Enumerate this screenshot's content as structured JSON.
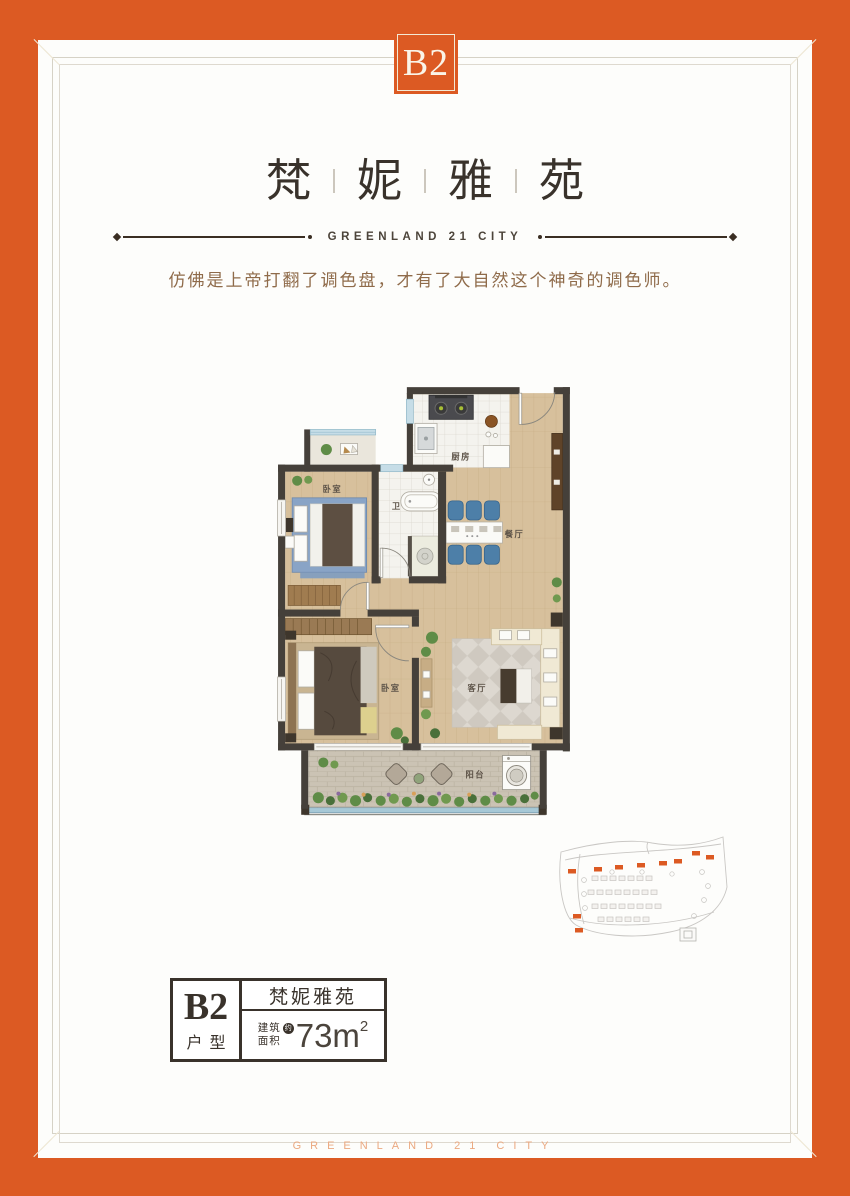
{
  "theme": {
    "accent": "#dc5a23",
    "ink": "#39322b",
    "divider": "#3a2e23",
    "brandtext": "#4c443a",
    "tagline": "#8f6b4a",
    "frameline1": "#d6d2c6",
    "frameline2": "#ded9cf",
    "tick": "#efe8d5",
    "watermark": "#eba981",
    "wall": "#45403a",
    "wood": "#d7c09c",
    "woodline": "#c3a981",
    "tile": "#f4f3ee",
    "tileline": "#dbd8cf",
    "stone": "#cbc3b4",
    "stoneline": "#b7af9e",
    "plant": "#5f8c47",
    "bluefurn": "#4d7fa8",
    "windowc": "#c6dde7",
    "railing": "#a6c8d6",
    "cream": "#f0e9d4",
    "roomlabel": "#5d5348",
    "infoink": "#39322b",
    "mapline": "#c9c7c4"
  },
  "badge": {
    "label": "B2"
  },
  "header": {
    "title_chars": [
      "梵",
      "妮",
      "雅",
      "苑"
    ],
    "brand": "GREENLAND 21 CITY",
    "tagline": "仿佛是上帝打翻了调色盘，才有了大自然这个神奇的调色师。"
  },
  "floorplan": {
    "rooms": {
      "kitchen": "厨房",
      "bath": "卫",
      "bedroom1": "卧室",
      "dining": "餐厅",
      "bedroom2": "卧室",
      "living": "客厅",
      "balcony": "阳台"
    }
  },
  "infobox": {
    "unit": "B2",
    "unit_type": "户型",
    "project": "梵妮雅苑",
    "area_label_line1": "建筑",
    "area_label_line2": "面积",
    "area_approx": "约",
    "area_value": "73m",
    "area_exponent": "2"
  },
  "footer": {
    "watermark": "GREENLAND 21 CITY"
  }
}
